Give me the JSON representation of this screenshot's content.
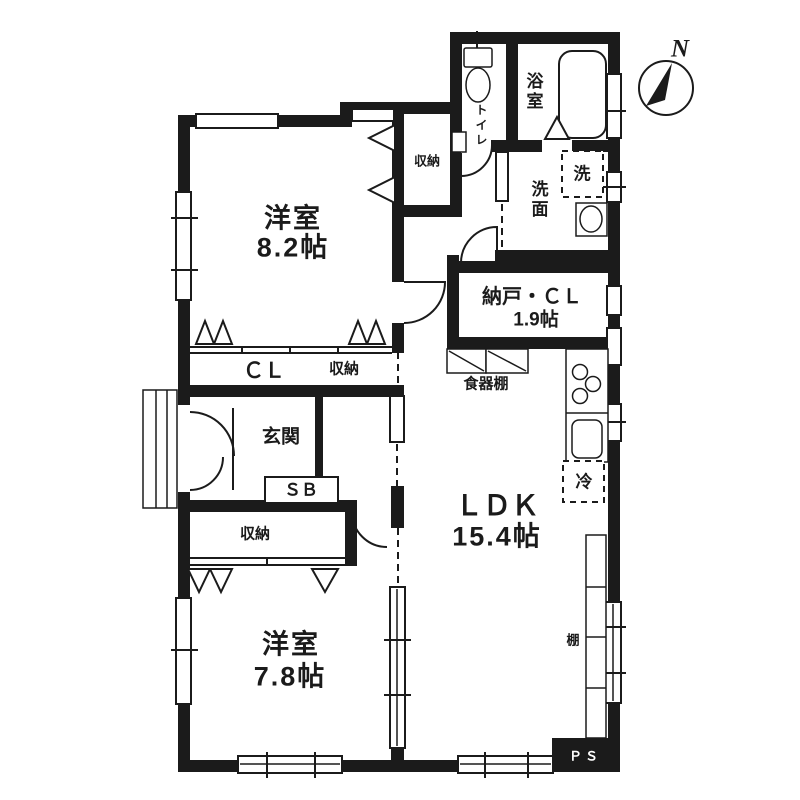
{
  "colors": {
    "ink": "#1b1b1b",
    "bg": "#ffffff"
  },
  "compass": {
    "north_label": "N"
  },
  "rooms": {
    "western1": {
      "name": "洋室",
      "size": "8.2帖"
    },
    "western2": {
      "name": "洋室",
      "size": "7.8帖"
    },
    "ldk": {
      "name": "ＬＤＫ",
      "size": "15.4帖"
    },
    "storage_room": {
      "name": "納戸・ＣＬ",
      "size": "1.9帖"
    },
    "entrance": {
      "name": "玄関"
    },
    "bath": {
      "name": "浴室"
    },
    "toilet": {
      "name": "トイレ"
    },
    "washroom": {
      "name": "洗面"
    }
  },
  "fixtures": {
    "closet_upper": "収納",
    "closet_cl": "ＣＬ",
    "closet_strip": "収納",
    "closet_lower": "収納",
    "cupboard": "食器棚",
    "shelf": "棚",
    "washer": "洗",
    "fridge": "冷",
    "shoe_box": "ＳＢ",
    "pipe_space": "ＰＳ"
  }
}
